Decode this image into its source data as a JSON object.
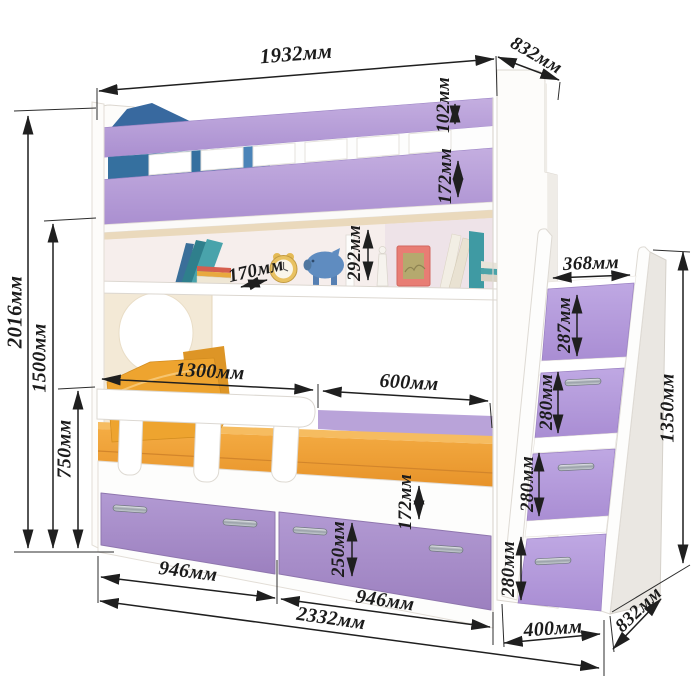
{
  "drawing": {
    "type": "furniture-dimension-diagram",
    "subject": "children bunk bed with shelf, guard rail, storage drawers and step-drawer stairs",
    "units": "мм"
  },
  "dims": {
    "length_top": "1932мм",
    "depth_top": "832мм",
    "rail_upper": "102мм",
    "rail_lower": "172мм",
    "shelf_height": "292мм",
    "shelf_depth": "170мм",
    "height_total": "2016мм",
    "height_upper_bed": "1500мм",
    "height_lower": "750мм",
    "guard_length": "1300мм",
    "open_length": "600мм",
    "step_width": "368мм",
    "step_top": "287мм",
    "step_second": "280мм",
    "step_third": "280мм",
    "step_fourth": "280мм",
    "stairs_height": "1350мм",
    "frame_band": "172мм",
    "drawer_height": "250мм",
    "drawer_left": "946мм",
    "drawer_right": "946мм",
    "length_total": "2332мм",
    "stairs_width": "400мм",
    "depth_bottom": "832мм"
  },
  "scene_items": [
    "blue-pillow",
    "white-slats",
    "wall-shelf",
    "leaning-books",
    "book-stack",
    "alarm-clock",
    "piggy-bank",
    "candlestick",
    "picture-frame",
    "porthole-cutout",
    "orange-pillows",
    "orange-mattress",
    "guard-rail",
    "drawer-handles",
    "step-drawers"
  ],
  "colors": {
    "board_purple": "#b49bd6",
    "drawer_purple": "#a88cc8",
    "mattress_orange": "#efa037",
    "pillow_blue": "#3a76ae",
    "panel_cream": "#f3e9d6",
    "dimension_ink": "#1f1f1f",
    "background": "#ffffff"
  }
}
